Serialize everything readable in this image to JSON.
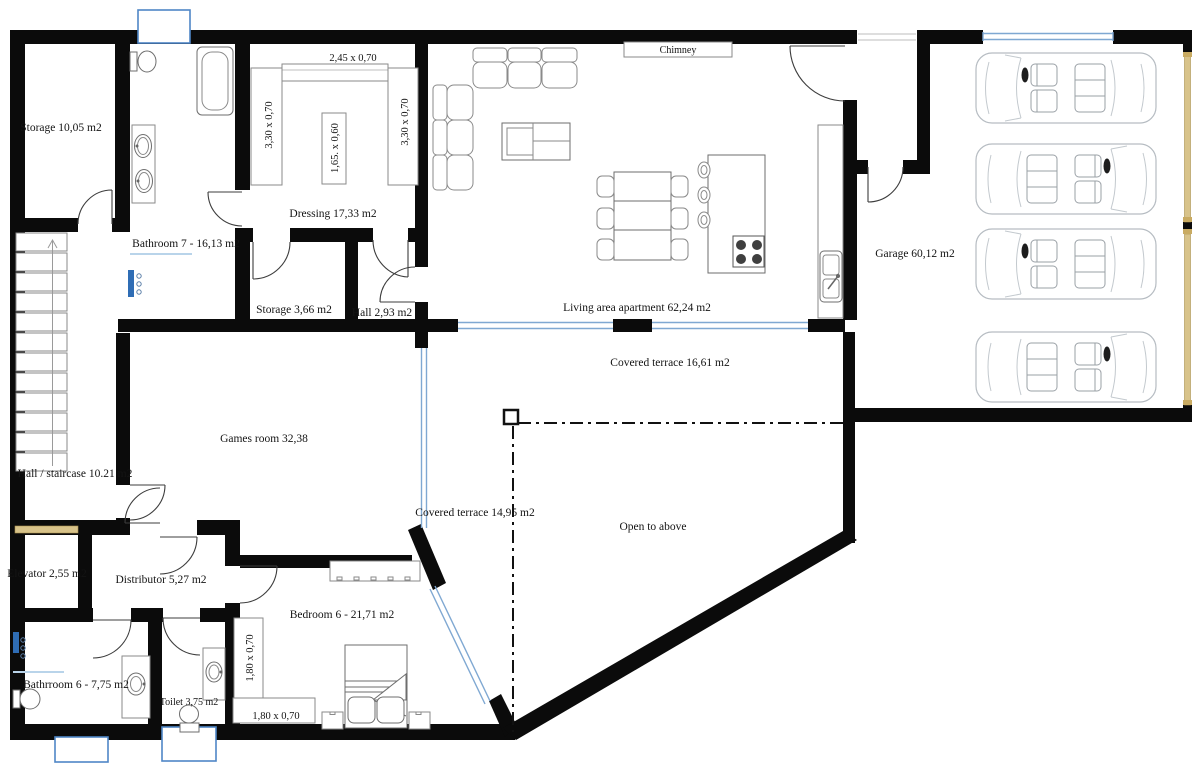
{
  "rooms": {
    "storage_upper": "Storage 10,05 m2",
    "bathroom7": "Bathroom 7 - 16,13 m2",
    "dressing": "Dressing 17,33 m2",
    "storage_small": "Storage 3,66 m2",
    "hall_small": "Hall 2,93 m2",
    "chimney": "Chimney",
    "living": "Living area apartment 62,24 m2",
    "garage": "Garage 60,12 m2",
    "terrace_upper": "Covered terrace 16,61 m2",
    "games_room": "Games room 32,38",
    "hall_staircase": "Hall / staircase 10.21 m2",
    "terrace_lower": "Covered terrace 14,95 m2",
    "open_above": "Open to above",
    "elevator": "Elevator 2,55 m2",
    "distributor": "Distributor 5,27 m2",
    "bedroom6": "Bedroom 6 - 21,71 m2",
    "bathroom6": "Bathrroom 6 - 7,75 m2",
    "toilet": "Toilet 3,75 m2"
  },
  "dimensions": {
    "dressing_top": "2,45 x 0,70",
    "dressing_left": "3,30 x 0,70",
    "dressing_island": "1,65. x 0,60",
    "dressing_right": "3,30 x 0,70",
    "bedroom_closet_left": "1,80 x 0,70",
    "bedroom_closet_bottom": "1,80 x 0,70"
  },
  "colors": {
    "wall": "#0b0b0b",
    "glass_blue": "#7fa8d2",
    "lightwell_border": "#4f86c6",
    "door_tan": "#d8c38a",
    "shower_blue": "#2f6db5"
  }
}
